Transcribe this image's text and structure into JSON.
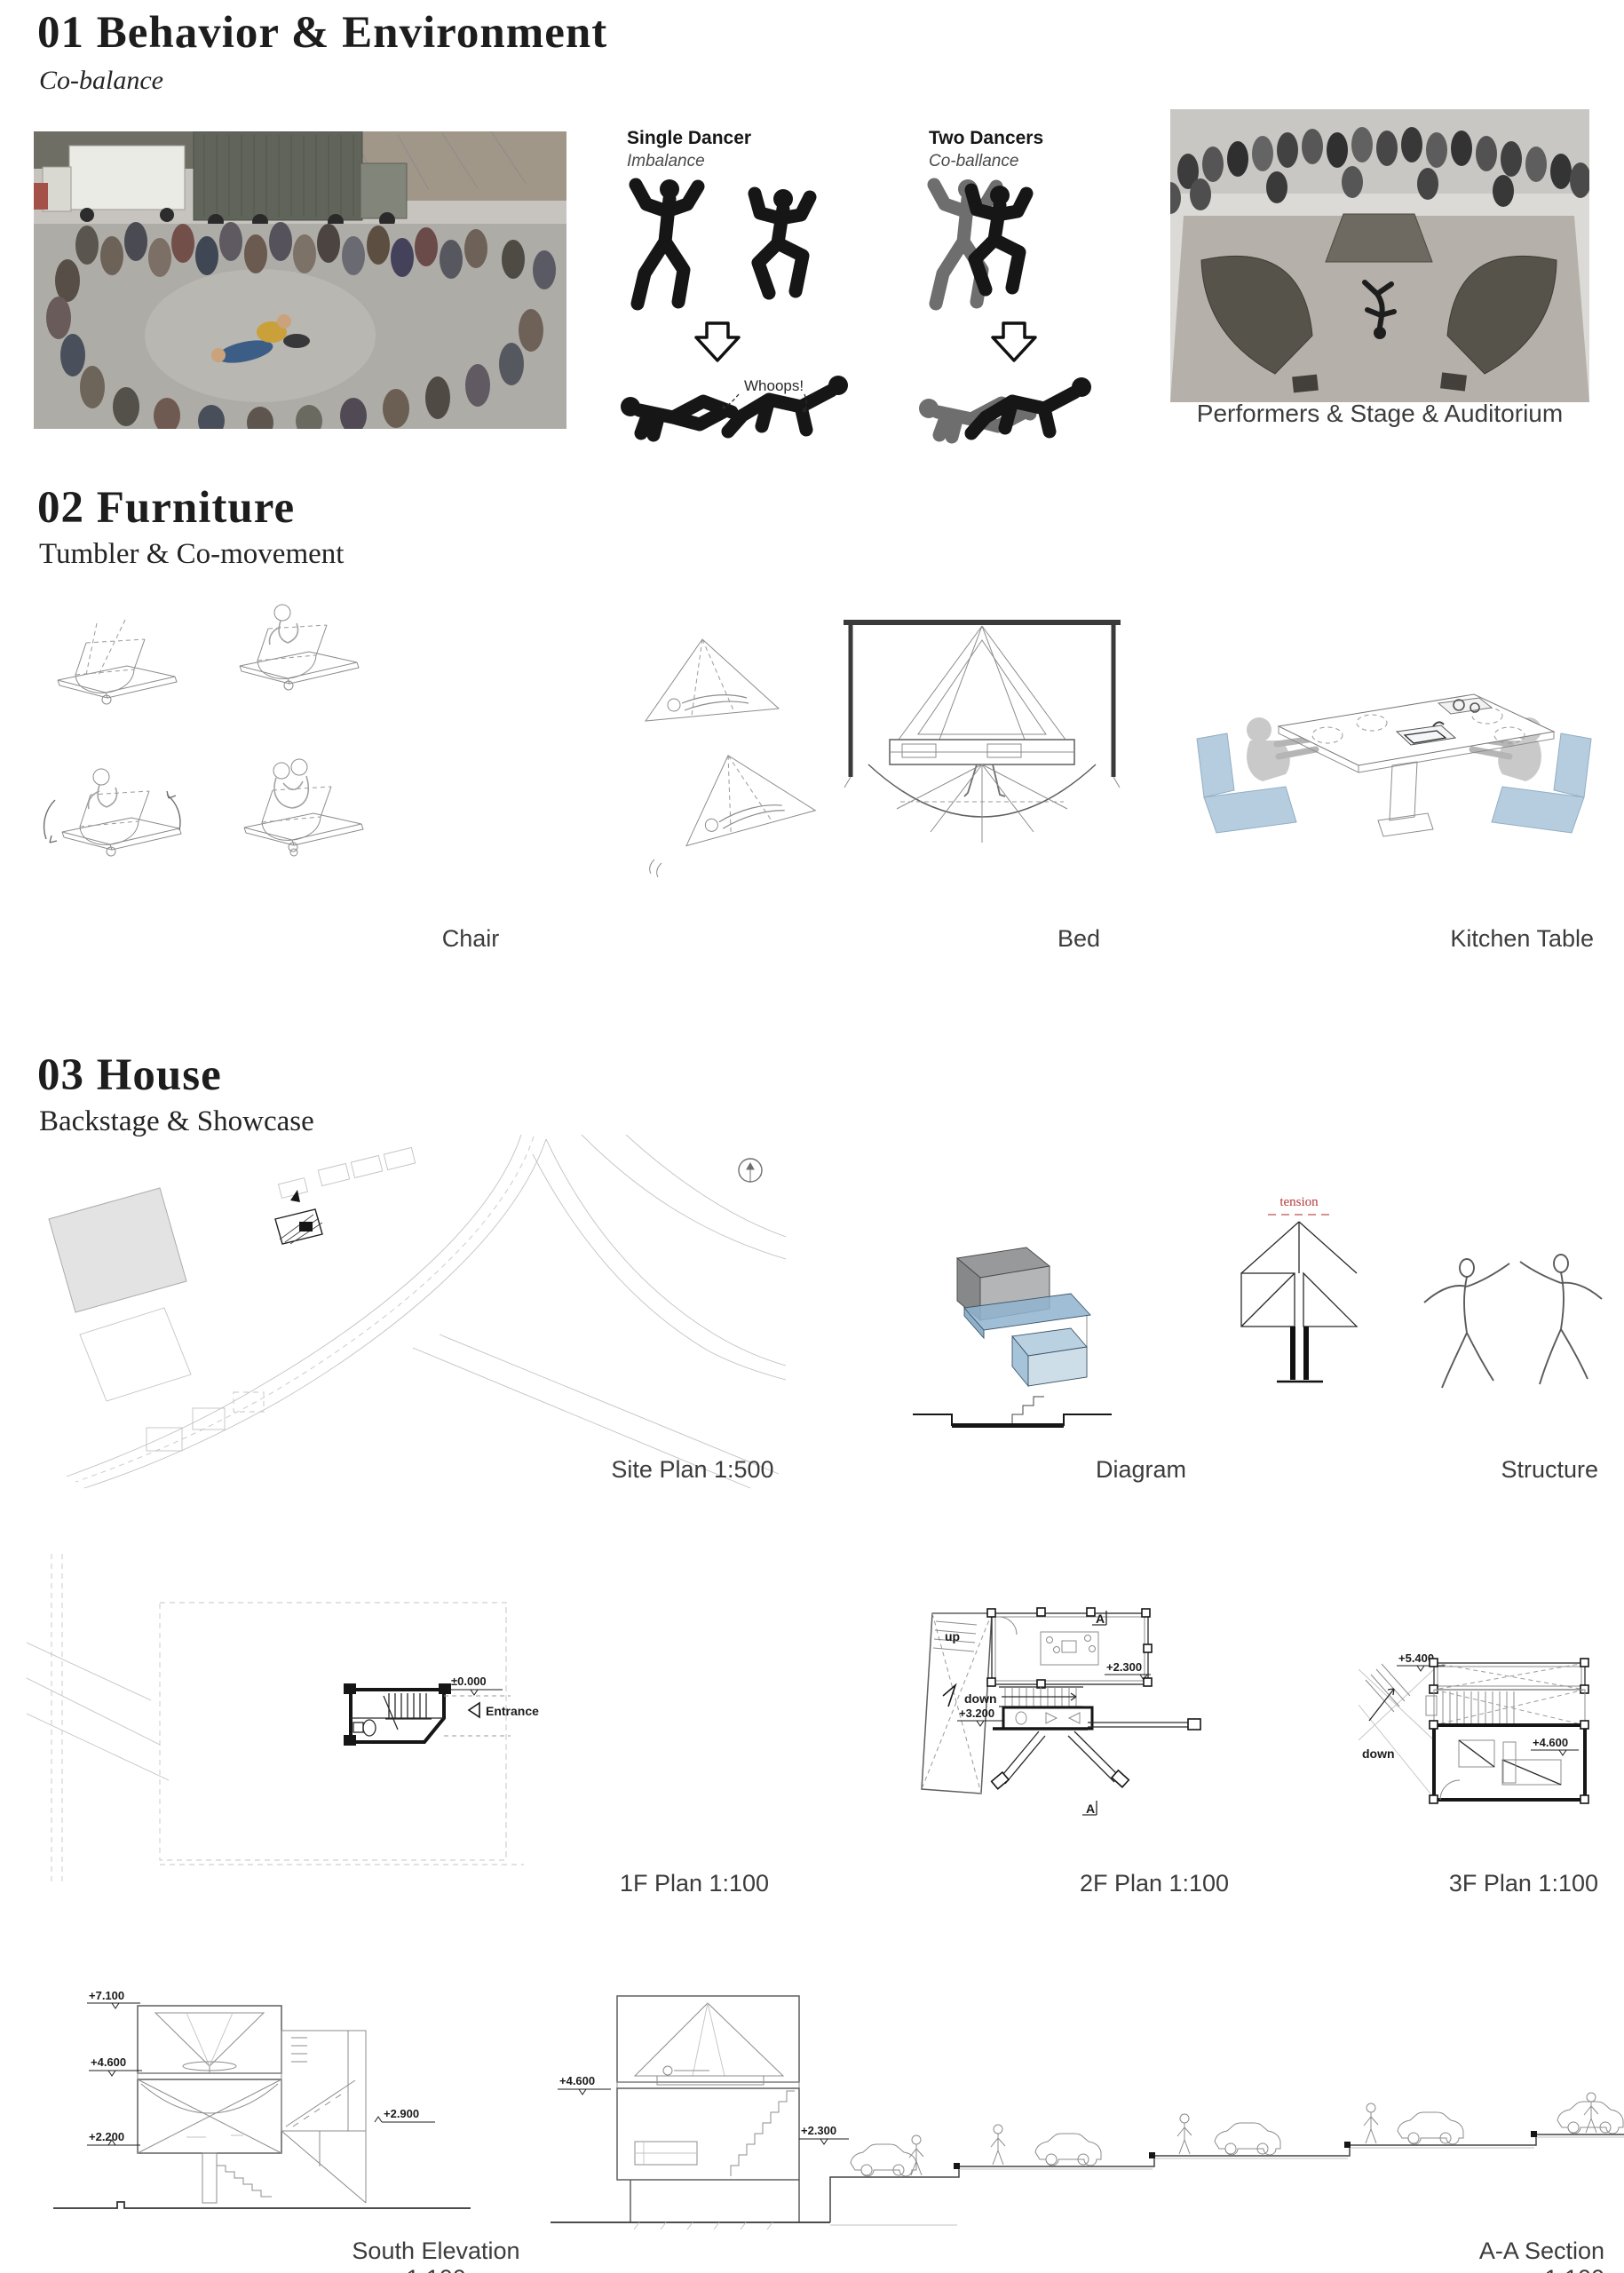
{
  "colors": {
    "accent_blue": "#b5cddf",
    "diagram_blue": "#8fb4cf",
    "tension_red": "#b23b3b",
    "heading_text": "#1d1d1d",
    "caption_gray": "#3c3c3c",
    "line_gray": "#8c8c8c"
  },
  "s1": {
    "title": "01 Behavior & Environment",
    "subtitle": "Co-balance",
    "single_dancer": "Single Dancer",
    "imbalance": "Imbalance",
    "two_dancers": "Two Dancers",
    "co_ballance": "Co-ballance",
    "whoops": "Whoops!",
    "stage_caption": "Performers & Stage & Auditorium"
  },
  "s2": {
    "title": "02 Furniture",
    "subtitle": "Tumbler & Co-movement",
    "chair": "Chair",
    "bed": "Bed",
    "kitchen_table": "Kitchen Table"
  },
  "s3": {
    "title": "03 House",
    "subtitle": "Backstage & Showcase",
    "site_plan": "Site Plan 1:500",
    "diagram": "Diagram",
    "structure": "Structure",
    "plan_1f": "1F Plan 1:100",
    "plan_2f": "2F Plan 1:100",
    "plan_3f": "3F Plan 1:100",
    "south_elevation": "South Elevation 1:100",
    "section_aa": "A-A Section 1:100",
    "ann": {
      "tension": "tension",
      "entrance": "Entrance",
      "level_zero": "±0.000",
      "up": "up",
      "down": "down",
      "l3200": "+3.200",
      "l2300": "+2.300",
      "l5400": "+5.400",
      "l4600": "+4.600",
      "marker_a": "A",
      "l7100": "+7.100",
      "l2200": "+2.200",
      "l2900": "+2.900"
    }
  }
}
